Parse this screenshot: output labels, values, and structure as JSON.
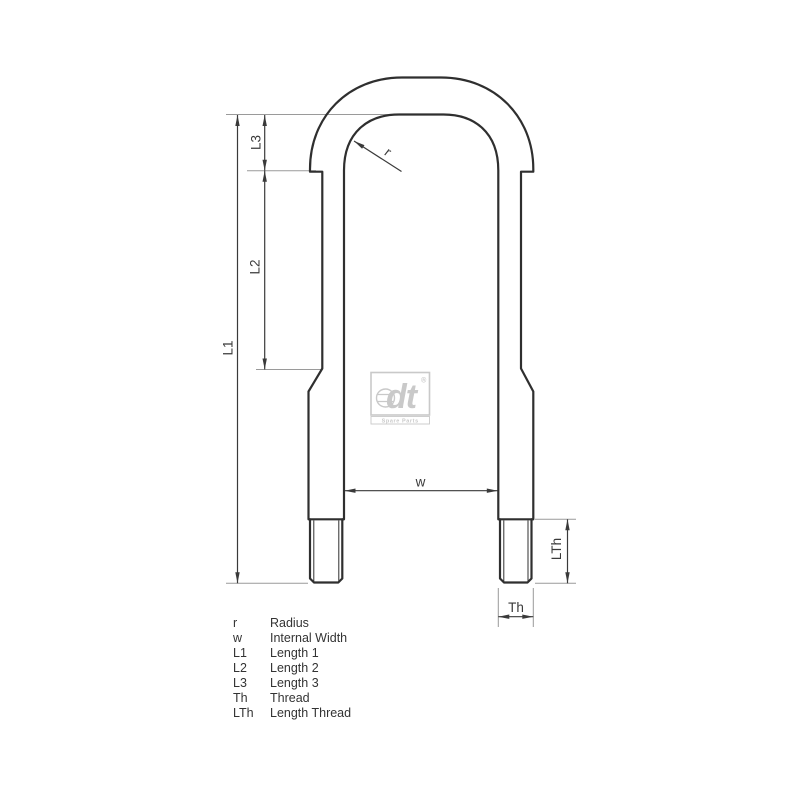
{
  "drawing": {
    "labels": {
      "r": "r",
      "w": "w",
      "l1": "L1",
      "l2": "L2",
      "l3": "L3",
      "th": "Th",
      "lth": "LTh"
    }
  },
  "legend": {
    "rows": [
      {
        "abbr": "r",
        "name": "Radius"
      },
      {
        "abbr": "w",
        "name": "Internal Width"
      },
      {
        "abbr": "L1",
        "name": "Length 1"
      },
      {
        "abbr": "L2",
        "name": "Length 2"
      },
      {
        "abbr": "L3",
        "name": "Length 3"
      },
      {
        "abbr": "Th",
        "name": "Thread"
      },
      {
        "abbr": "LTh",
        "name": "Length Thread"
      }
    ]
  },
  "logo": {
    "text": "dt",
    "registered": "®",
    "subtext": "Spare Parts"
  },
  "colors": {
    "background": "#ffffff",
    "outline": "#2f2f2f",
    "dimension": "#3a3a3a",
    "extension": "#9a9a9a",
    "text": "#333333",
    "logo": "#c9c9c9"
  }
}
